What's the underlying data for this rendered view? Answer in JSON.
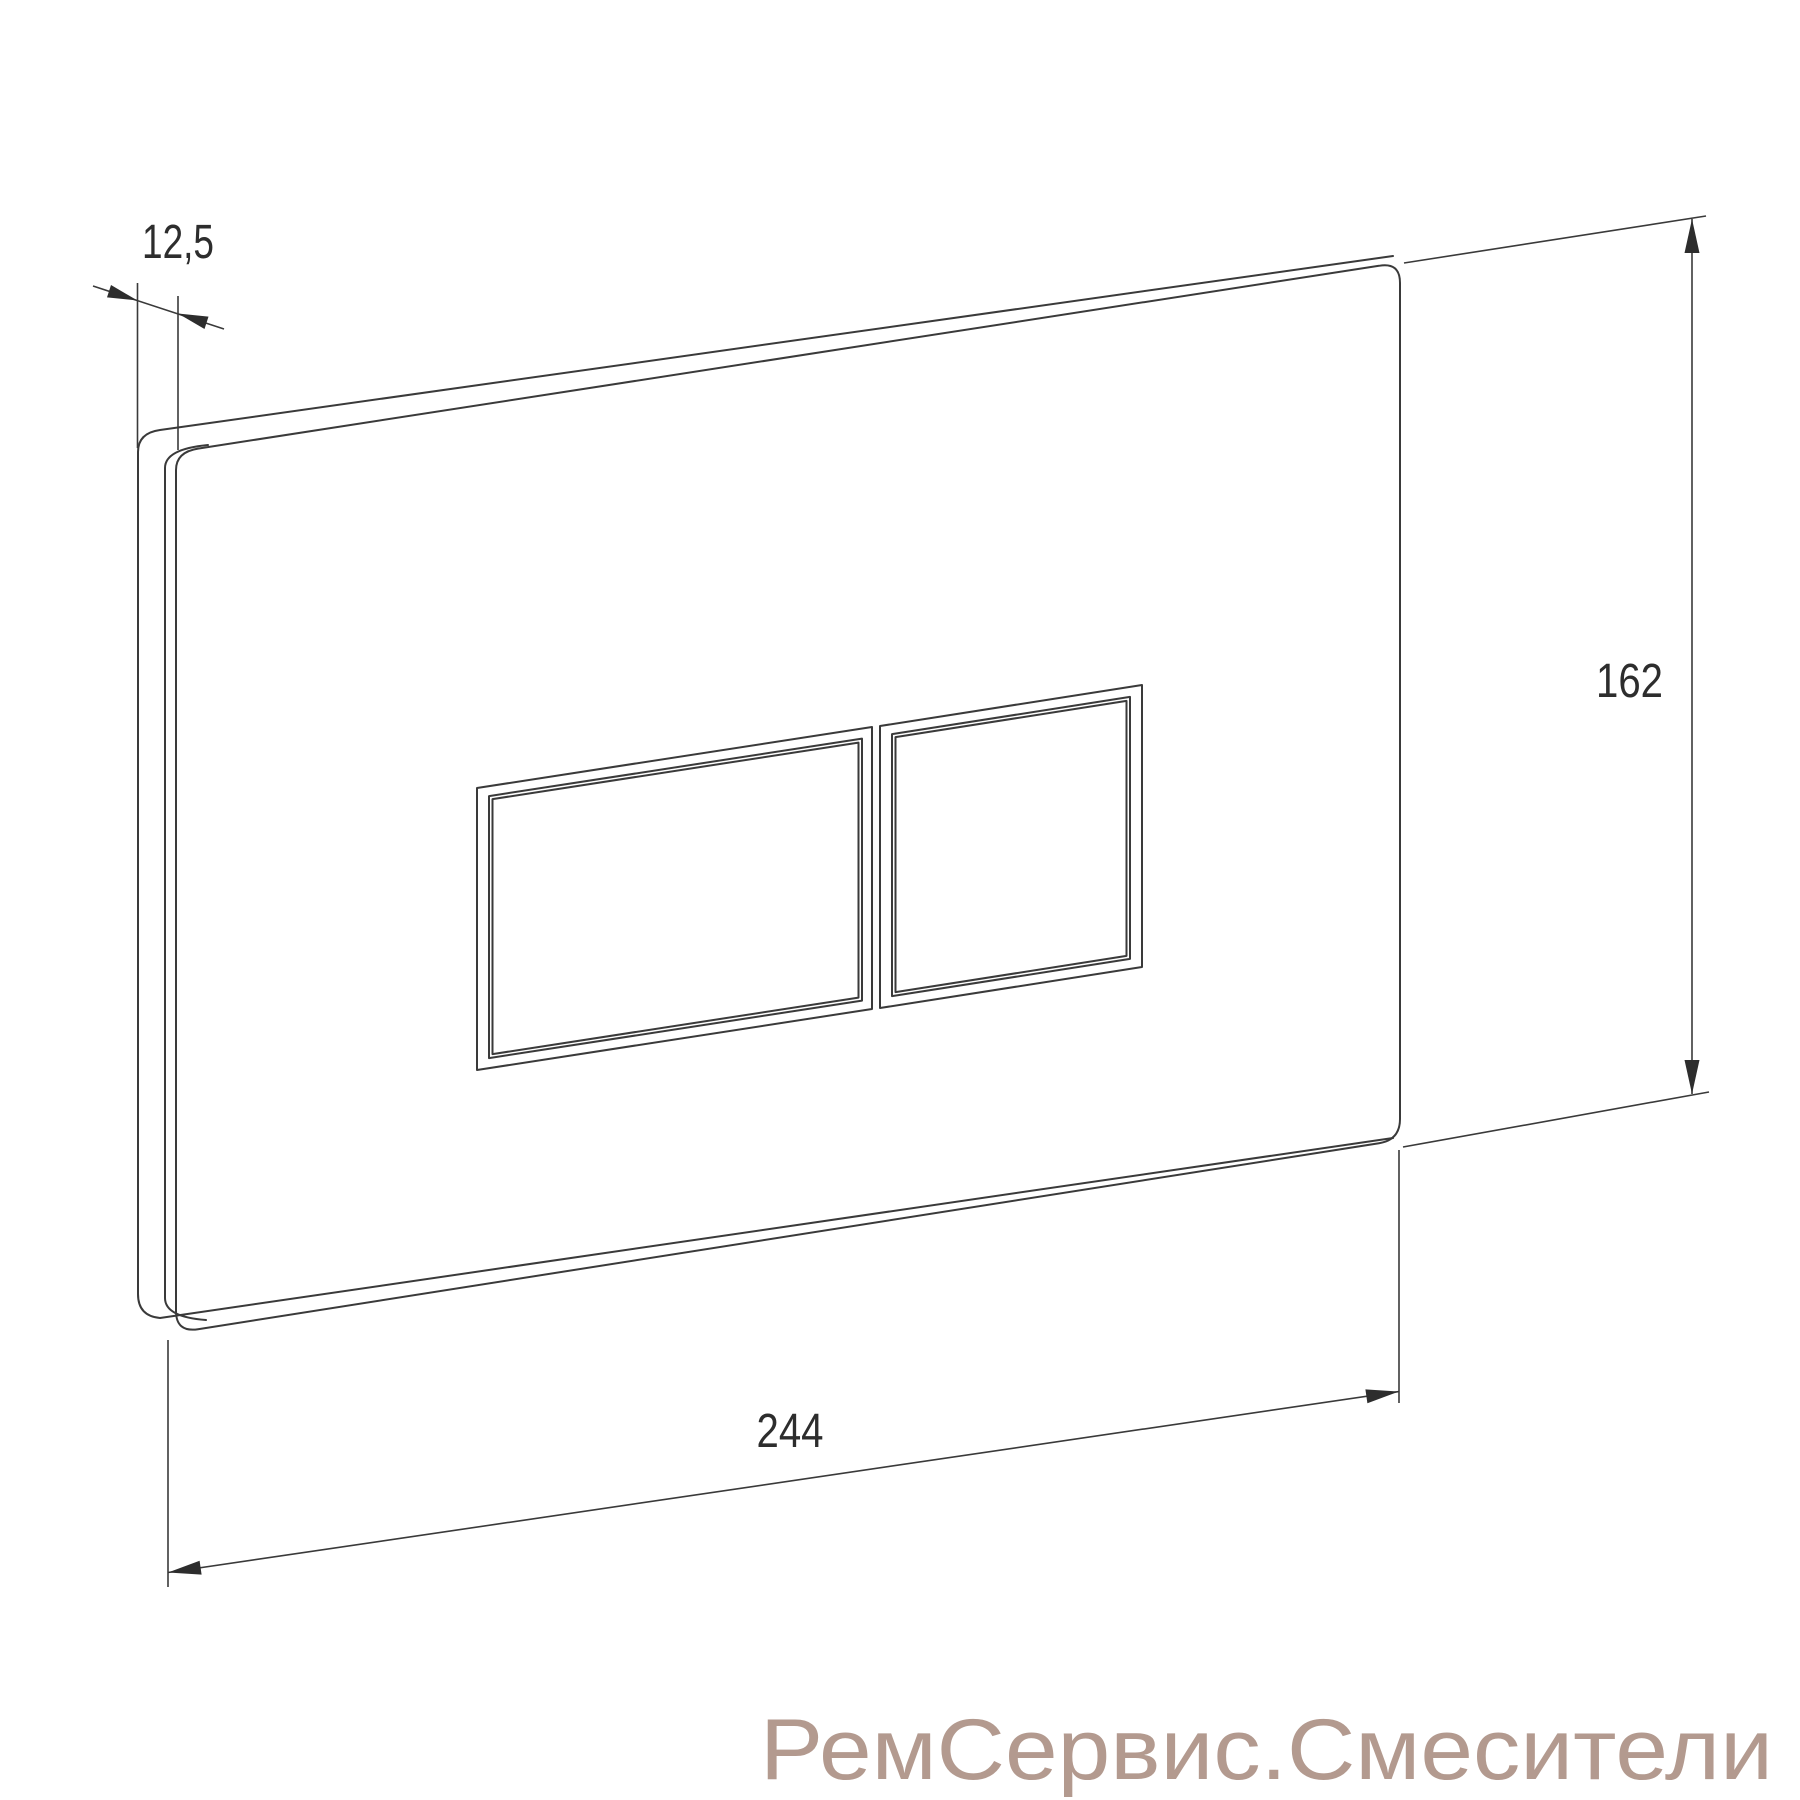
{
  "drawing": {
    "type": "technical-dimension-drawing",
    "subject": "wall-mounted dual flush plate with two rectangular buttons",
    "line_color": "#3a3a3a",
    "background": "#ffffff",
    "dimensions": {
      "thickness": {
        "label": "12,5"
      },
      "height": {
        "label": "162"
      },
      "width": {
        "label": "244"
      }
    },
    "watermark": {
      "text": "РемСервис.Смесители",
      "color": "#b39a8f"
    }
  }
}
